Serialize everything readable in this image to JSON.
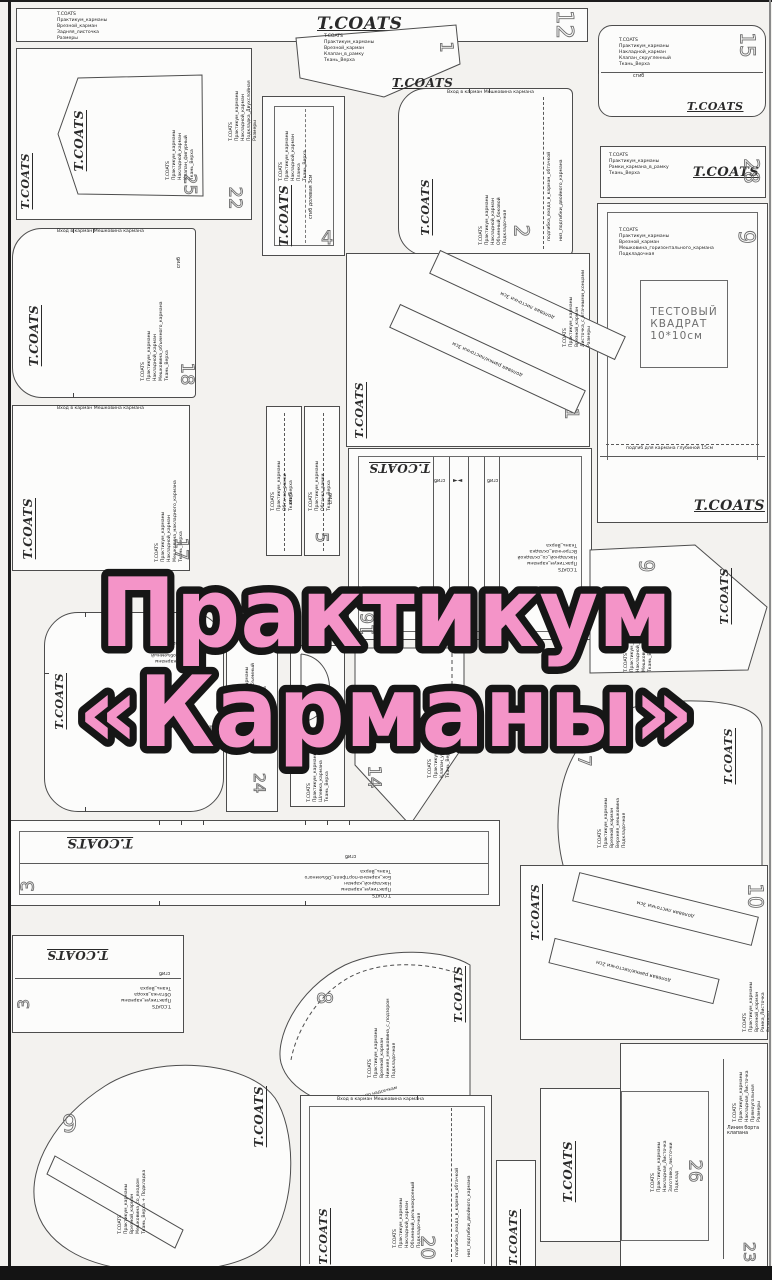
{
  "title": {
    "line1": "Практикум",
    "line2": "«Карманы»",
    "fill_color": "#f494c8",
    "outline_color": "#161616"
  },
  "labels": {
    "brand": "T.COATS",
    "fold": "сгиб",
    "pocket_entry": "Вход в карман    Мешковина кармана",
    "grain_welt_3": "долевая   листочки   3см",
    "grain_frame_3": "долевая   рамки/листочки   3см",
    "grain_welt_3b": "долевая   листочки   3см",
    "grain_frame_2": "долевая   рамки/листочки   2см",
    "flap_edge_line": "Линия борта клапана"
  },
  "pieces": {
    "strip12": {
      "num": "12",
      "info": [
        "T.COATS",
        "Практикум_карманы",
        "Врезной_карман",
        "Задняя_листочка",
        "Размеры"
      ]
    },
    "flap1": {
      "num": "1",
      "info": [
        "T.COATS",
        "Практикум_карманы",
        "Врезной_карман",
        "Клапан_в_рамку",
        "Ткань_Верха"
      ]
    },
    "flap15": {
      "num": "15",
      "info": [
        "T.COATS",
        "Практикум_карманы",
        "Накладной_карман",
        "Клапан_скругленный",
        "Ткань_Верха"
      ]
    },
    "rect22": {
      "num": "22",
      "info": [
        "T.COATS",
        "Практикум_карманы",
        "Накладной_карман",
        "Подкладка_Двухслойная",
        "Размеры"
      ]
    },
    "flap25": {
      "num": "25",
      "info": [
        "T.COATS",
        "Практикум_карманы",
        "Накладной_карман",
        "Клапан_фигурный",
        "Ткань_Верха"
      ]
    },
    "strip28": {
      "num": "28",
      "info": [
        "T.COATS",
        "Практикум_карманы",
        "Рамки_кармана_в_рамку",
        "Ткань_Верха"
      ]
    },
    "strip4": {
      "num": "4",
      "info": [
        "T.COATS",
        "Практикум_карманы",
        "Накладной_карман",
        "Планка",
        "Ткань_Верха"
      ],
      "fold_note": "сгиб    долевая    3см"
    },
    "pocket2": {
      "num": "2",
      "info": [
        "T.COATS",
        "Практикум_карманы",
        "Накладной_карман",
        "Объемный_боковой",
        "Подкладочная"
      ],
      "side_note1": "подгибка_входа_в_карман_обтачкой",
      "side_note2": "низ_подгибки_двойного_кармана"
    },
    "test9": {
      "num": "9",
      "info": [
        "T.COATS",
        "Практикум_карманы",
        "Врезной_карман",
        "Мешковина_горизонтального_кармана",
        "Подкладочная"
      ],
      "square": [
        "ТЕСТОВЫЙ",
        "КВАДРАТ",
        "10*10см"
      ],
      "depth_note": "подгиб  для  кармана  глубиной  15см"
    },
    "pocket18": {
      "num": "18",
      "info": [
        "T.COATS",
        "Практикум_карманы",
        "Накладной_карман",
        "Мешковина_объемного_кармана",
        "Ткань_Верха"
      ]
    },
    "pocket17": {
      "num": "17",
      "info": [
        "T.COATS",
        "Практикум_карманы",
        "Накладной_карман",
        "Мешковина_накладного_кармана",
        "Ткань_Верха"
      ]
    },
    "strip5": {
      "num": "5",
      "info": [
        "T.COATS",
        "Практикум_карманы",
        "Обтачка_рамки",
        "Ткань_Верха"
      ],
      "info2": [
        "T.COATS",
        "Практикум_карманы",
        "Обтачка_рамки",
        "Ткань_Верха"
      ]
    },
    "welt1": {
      "num": "1",
      "info": [
        "T.COATS",
        "Практикум_карманы",
        "Врезной_карман",
        "Листочка_с_втачными_концами",
        "Размеры"
      ]
    },
    "pleat16": {
      "num": "16",
      "info": [
        "T.COATS",
        "Практикум_карманы",
        "Накладной_со_складкой",
        "Встречная_складка",
        "Ткань_Верха"
      ]
    },
    "flap9r": {
      "num": "9",
      "info": [
        "T.COATS",
        "Практикум_карманы",
        "Накладной_карман",
        "Мешковина",
        "Ткань_Верха"
      ]
    },
    "pocket27": {
      "num": "27",
      "info": [
        "T.COATS",
        "Практикум_карманы",
        "Накладной_объемный",
        "Размеры",
        "Подкладочная"
      ]
    },
    "strip24": {
      "num": "24",
      "info": [
        "T.COATS",
        "Практикум_карманы",
        "Накладной_объемный",
        "Бок_кармана",
        "Ткань_Верха"
      ]
    },
    "loop": {
      "info": [
        "T.COATS",
        "Практикум_карманы",
        "Шлевка_кармана",
        "Ткань_Верха"
      ]
    },
    "flap14": {
      "num": "14",
      "info": [
        "T.COATS",
        "Практикум_карманы",
        "Клапан_угловой",
        "Ткань_Верха"
      ]
    },
    "bag7": {
      "num": "7",
      "info": [
        "T.COATS",
        "Практикум_карманы",
        "Врезной_карман",
        "Верхняя_мешковина",
        "Подкладочная"
      ]
    },
    "strip3": {
      "num": "3",
      "info": [
        "T.COATS",
        "Практикум_карманы",
        "Накладной_карман",
        "Бок_кармана-портфеля_Объемного",
        "Ткань_Верха"
      ]
    },
    "welt10": {
      "num": "10",
      "info": [
        "T.COATS",
        "Практикум_карманы",
        "Врезной_карман",
        "Рамка_Листочка",
        "Размеры"
      ]
    },
    "fold3": {
      "num": "3",
      "info": [
        "T.COATS",
        "Практикум_карманы",
        "Обтачка_входа",
        "Ткань_Верха"
      ]
    },
    "bag8": {
      "num": "8",
      "info": [
        "T.COATS",
        "Практикум_карманы",
        "Врезной_карман",
        "Нижняя_мешковина_с_подзором",
        "Подкладочная"
      ],
      "note": "вход в карман по надсечкам"
    },
    "bag9": {
      "num": "9",
      "info": [
        "T.COATS",
        "Практикум_карманы",
        "Врезной_карман",
        "Мешковина_со_входом",
        "Ткань_Верха + Подкладка"
      ]
    },
    "pocket20": {
      "num": "20",
      "info": [
        "T.COATS",
        "Практикум_карманы",
        "Накладной_карман",
        "Объемный_цельнокроеный",
        "Подкладочная"
      ],
      "side_note1": "подгибка_входа_в_карман_обтачкой",
      "side_note2": "низ_подгибки_двойного_кармана"
    },
    "welt26": {
      "num": "26",
      "info": [
        "T.COATS",
        "Практикум_карманы",
        "Накладная_Листочка",
        "Заготовка_листочки",
        "Подклад"
      ]
    },
    "rect23": {
      "num": "23",
      "info": [
        "T.COATS",
        "Практикум_карманы",
        "Накладная_Листочка",
        "Прямоугольная",
        "Размеры"
      ]
    }
  }
}
